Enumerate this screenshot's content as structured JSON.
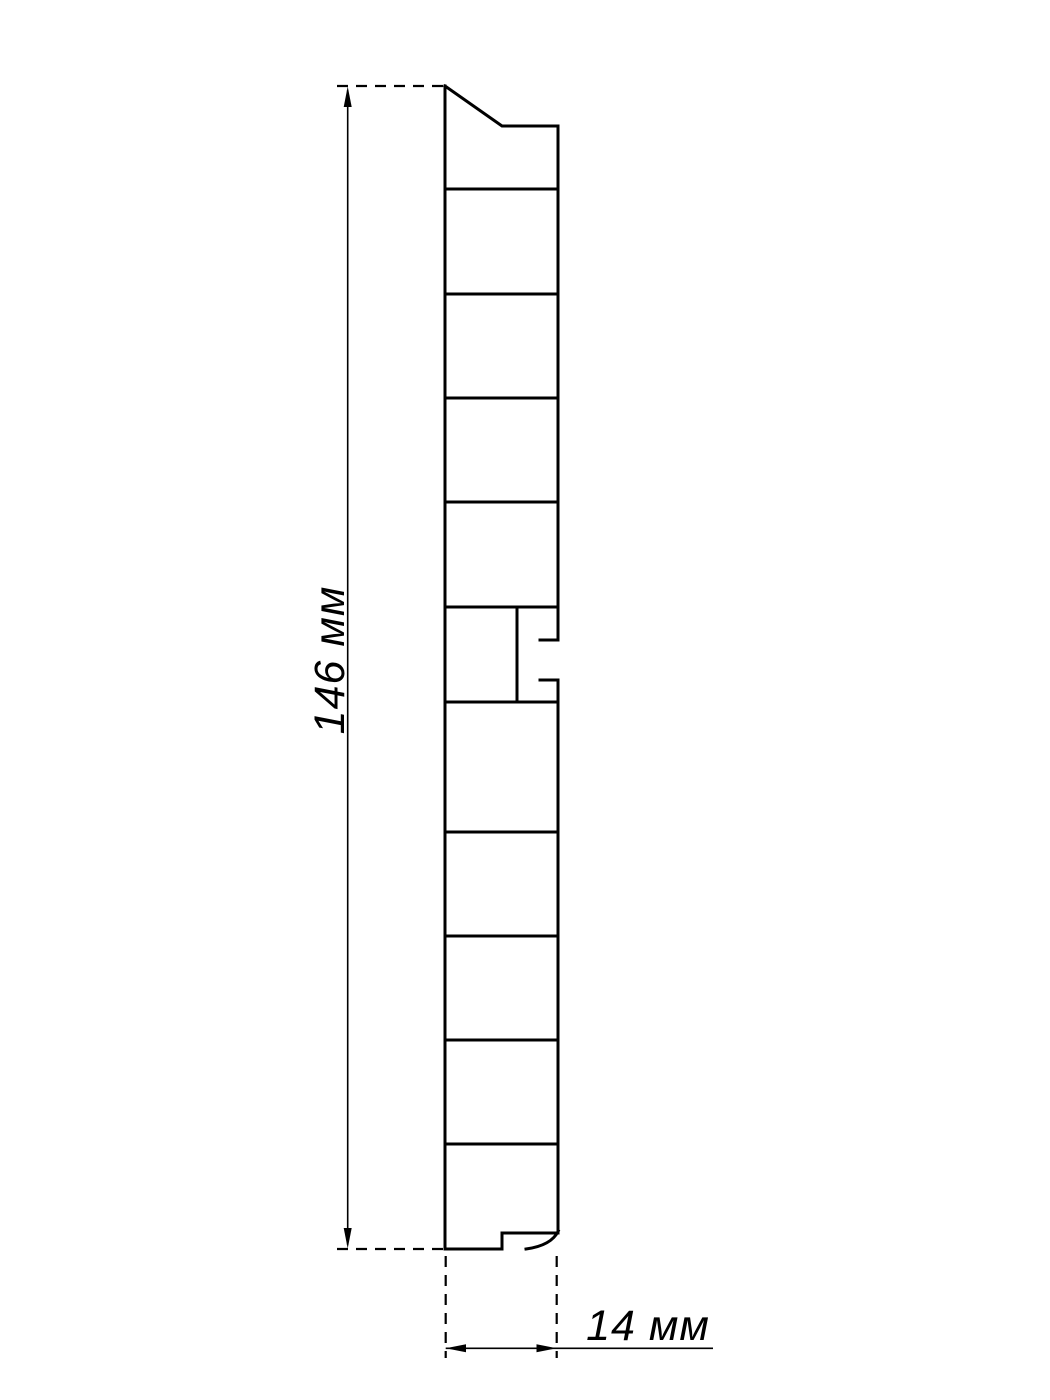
{
  "drawing": {
    "type": "technical-cross-section-profile",
    "background_color": "#ffffff",
    "line_color": "#000000",
    "height_dimension": {
      "label": "146 мм",
      "value_mm": 146
    },
    "width_dimension": {
      "label": "14 мм",
      "value_mm": 14
    }
  }
}
